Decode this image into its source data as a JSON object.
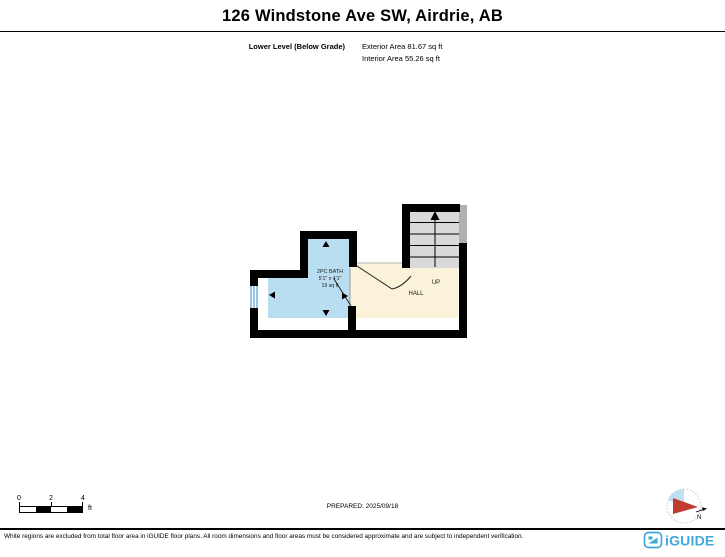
{
  "header": {
    "title": "126 Windstone Ave SW, Airdrie, AB",
    "level_label": "Lower Level (Below Grade)",
    "exterior_area": "Exterior Area 81.67 sq ft",
    "interior_area": "Interior Area 55.26 sq ft"
  },
  "plan": {
    "rooms": {
      "bath": {
        "name": "2PC BATH",
        "dimensions": "5'1\" x 4'1\"",
        "area": "19 sq ft"
      },
      "hall": {
        "name": "HALL"
      },
      "stairs": {
        "label": "UP"
      }
    },
    "colors": {
      "bath_fill": "#b9ddf1",
      "hall_fill": "#faf3da",
      "stairs_fill": "#d9d9d9",
      "partial_wall": "#b0b0b0",
      "wall": "#000000",
      "window": "#4f9fd0"
    }
  },
  "scale_bar": {
    "ticks": [
      "0",
      "2",
      "4"
    ],
    "unit": "ft"
  },
  "prepared": {
    "text": "PREPARED: 2025/09/18"
  },
  "compass": {
    "north_label": "N",
    "needle_color": "#c23b30",
    "fill_color": "#bfe0f2"
  },
  "footer": {
    "disclaimer": "White regions are excluded from total floor area in iGUIDE floor plans. All room dimensions and floor areas must be considered approximate and are subject to independent verification.",
    "brand": "iGUIDE",
    "brand_color": "#41a8da"
  }
}
